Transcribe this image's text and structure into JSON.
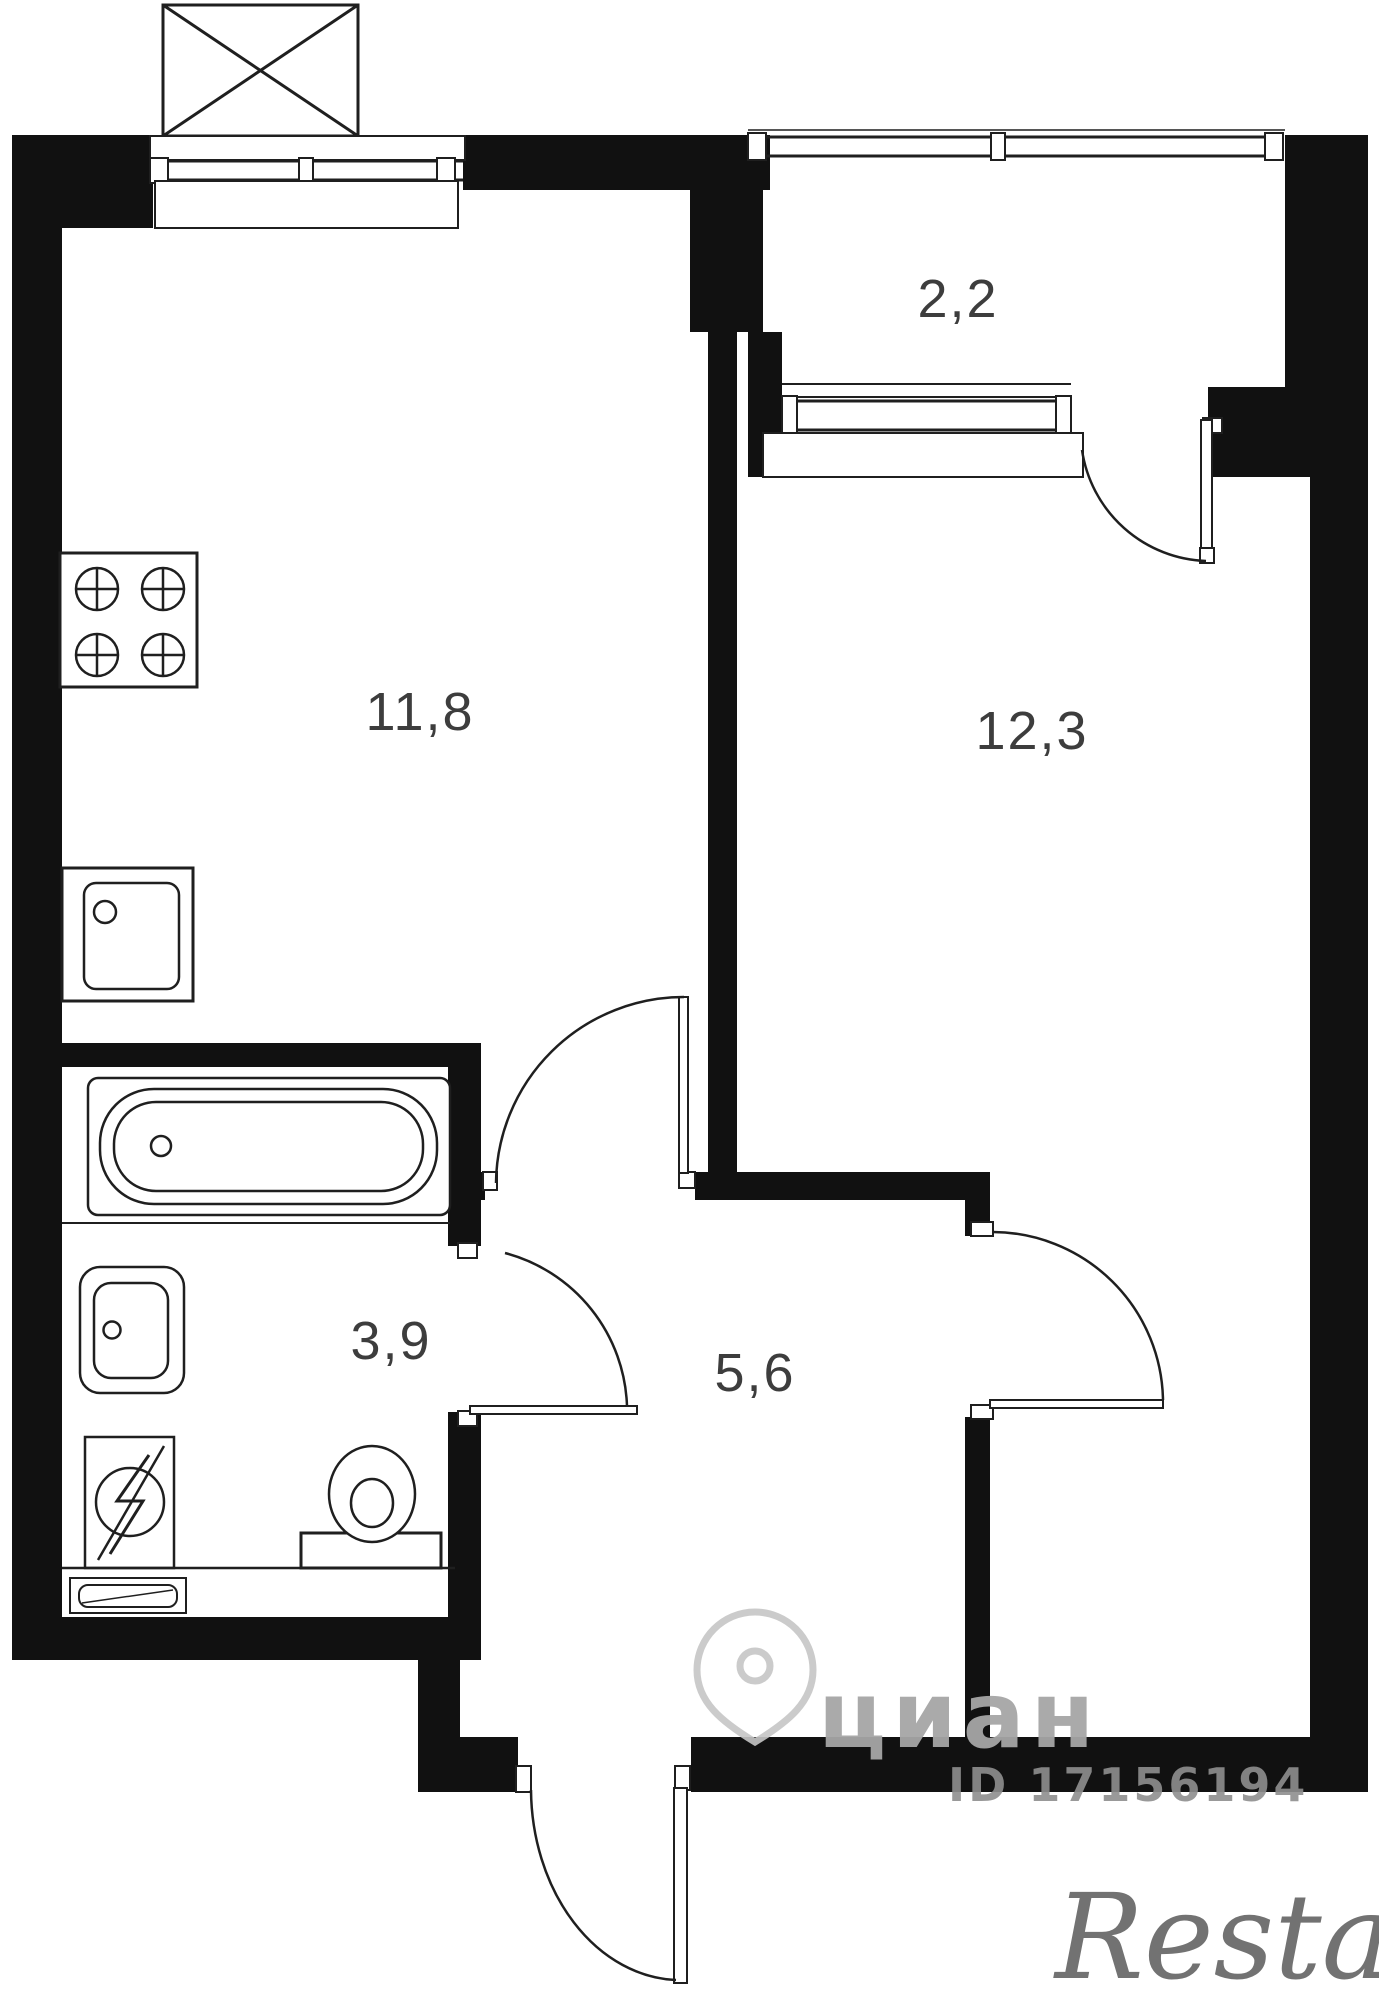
{
  "plan": {
    "type": "apartment-floor-plan",
    "colors": {
      "wall": "#111111",
      "line": "#1f1f1f",
      "background": "#ffffff",
      "label": "#3d3d3d",
      "watermark_gray": "#a6a6a6",
      "watermark_id_gray": "#8f8f8f",
      "watermark_agency_gray": "#5a5a5a",
      "pin_outline": "#c6c6c6"
    },
    "rooms": {
      "kitchen": {
        "area_label": "11,8"
      },
      "living_room": {
        "area_label": "12,3"
      },
      "balcony": {
        "area_label": "2,2"
      },
      "bathroom": {
        "area_label": "3,9"
      },
      "hallway": {
        "area_label": "5,6"
      }
    },
    "fixtures": [
      "ventilation-shaft-icon",
      "gas-stove-icon",
      "kitchen-sink-icon",
      "bathtub-icon",
      "washbasin-icon",
      "washing-machine-icon",
      "toilet-icon",
      "radiator-icon",
      "window",
      "balcony-door",
      "interior-door",
      "entrance-door"
    ],
    "watermarks": {
      "logo_text": "циан",
      "listing_id": "ID 17156194",
      "agency": "Restate",
      "pin_icon": "map-pin-icon"
    }
  }
}
